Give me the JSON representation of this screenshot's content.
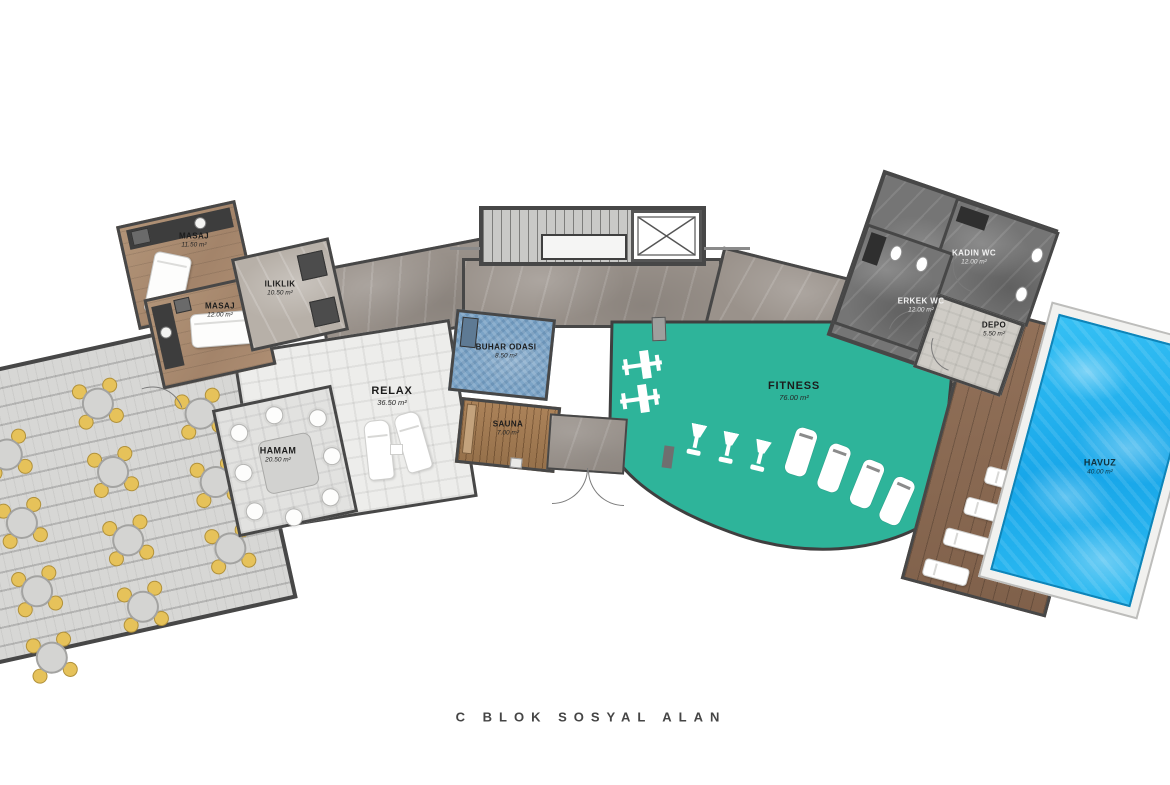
{
  "plan": {
    "caption": "C BLOK SOSYAL ALAN"
  },
  "rooms": {
    "masaj1": {
      "name": "MASAJ",
      "area": "11.50 m²"
    },
    "masaj2": {
      "name": "MASAJ",
      "area": "12.00 m²"
    },
    "iliklik": {
      "name": "ILIKLIK",
      "area": "10.50 m²"
    },
    "relax": {
      "name": "RELAX",
      "area": "36.50 m²"
    },
    "hamam": {
      "name": "HAMAM",
      "area": "20.50 m²"
    },
    "buhar_odasi": {
      "name": "BUHAR ODASI",
      "area": "8.50 m²"
    },
    "sauna": {
      "name": "SAUNA",
      "area": "7.00 m²"
    },
    "fitness": {
      "name": "FITNESS",
      "area": "76.00 m²"
    },
    "erkek_wc": {
      "name": "ERKEK WC",
      "area": "12.00 m²"
    },
    "kadin_wc": {
      "name": "KADIN WC",
      "area": "12.00 m²"
    },
    "depo": {
      "name": "DEPO",
      "area": "5.50 m²"
    },
    "havuz": {
      "name": "HAVUZ",
      "area": "40.00 m²"
    }
  },
  "colors": {
    "fitness_floor": "#2eb49a",
    "pool_water": "#29b7ef",
    "steam_room_tile": "#7ba3c6",
    "sauna_wood": "#a07a52",
    "deck_wood": "#8a6950",
    "massage_floor": "#ab8a6e",
    "terrace_deck": "#d7d7d5",
    "marble_corridor": "#9a928b",
    "wall": "#474747",
    "chair_accent": "#e6c25a"
  },
  "furniture": {
    "terrace_tables": 11,
    "chairs_per_table": 4,
    "relax_loungers": 2,
    "hamam_stools": 8,
    "pool_sunbeds": 6,
    "fitness_equipment": {
      "bench_stations": 2,
      "bikes": 3,
      "treadmills": 4
    }
  }
}
